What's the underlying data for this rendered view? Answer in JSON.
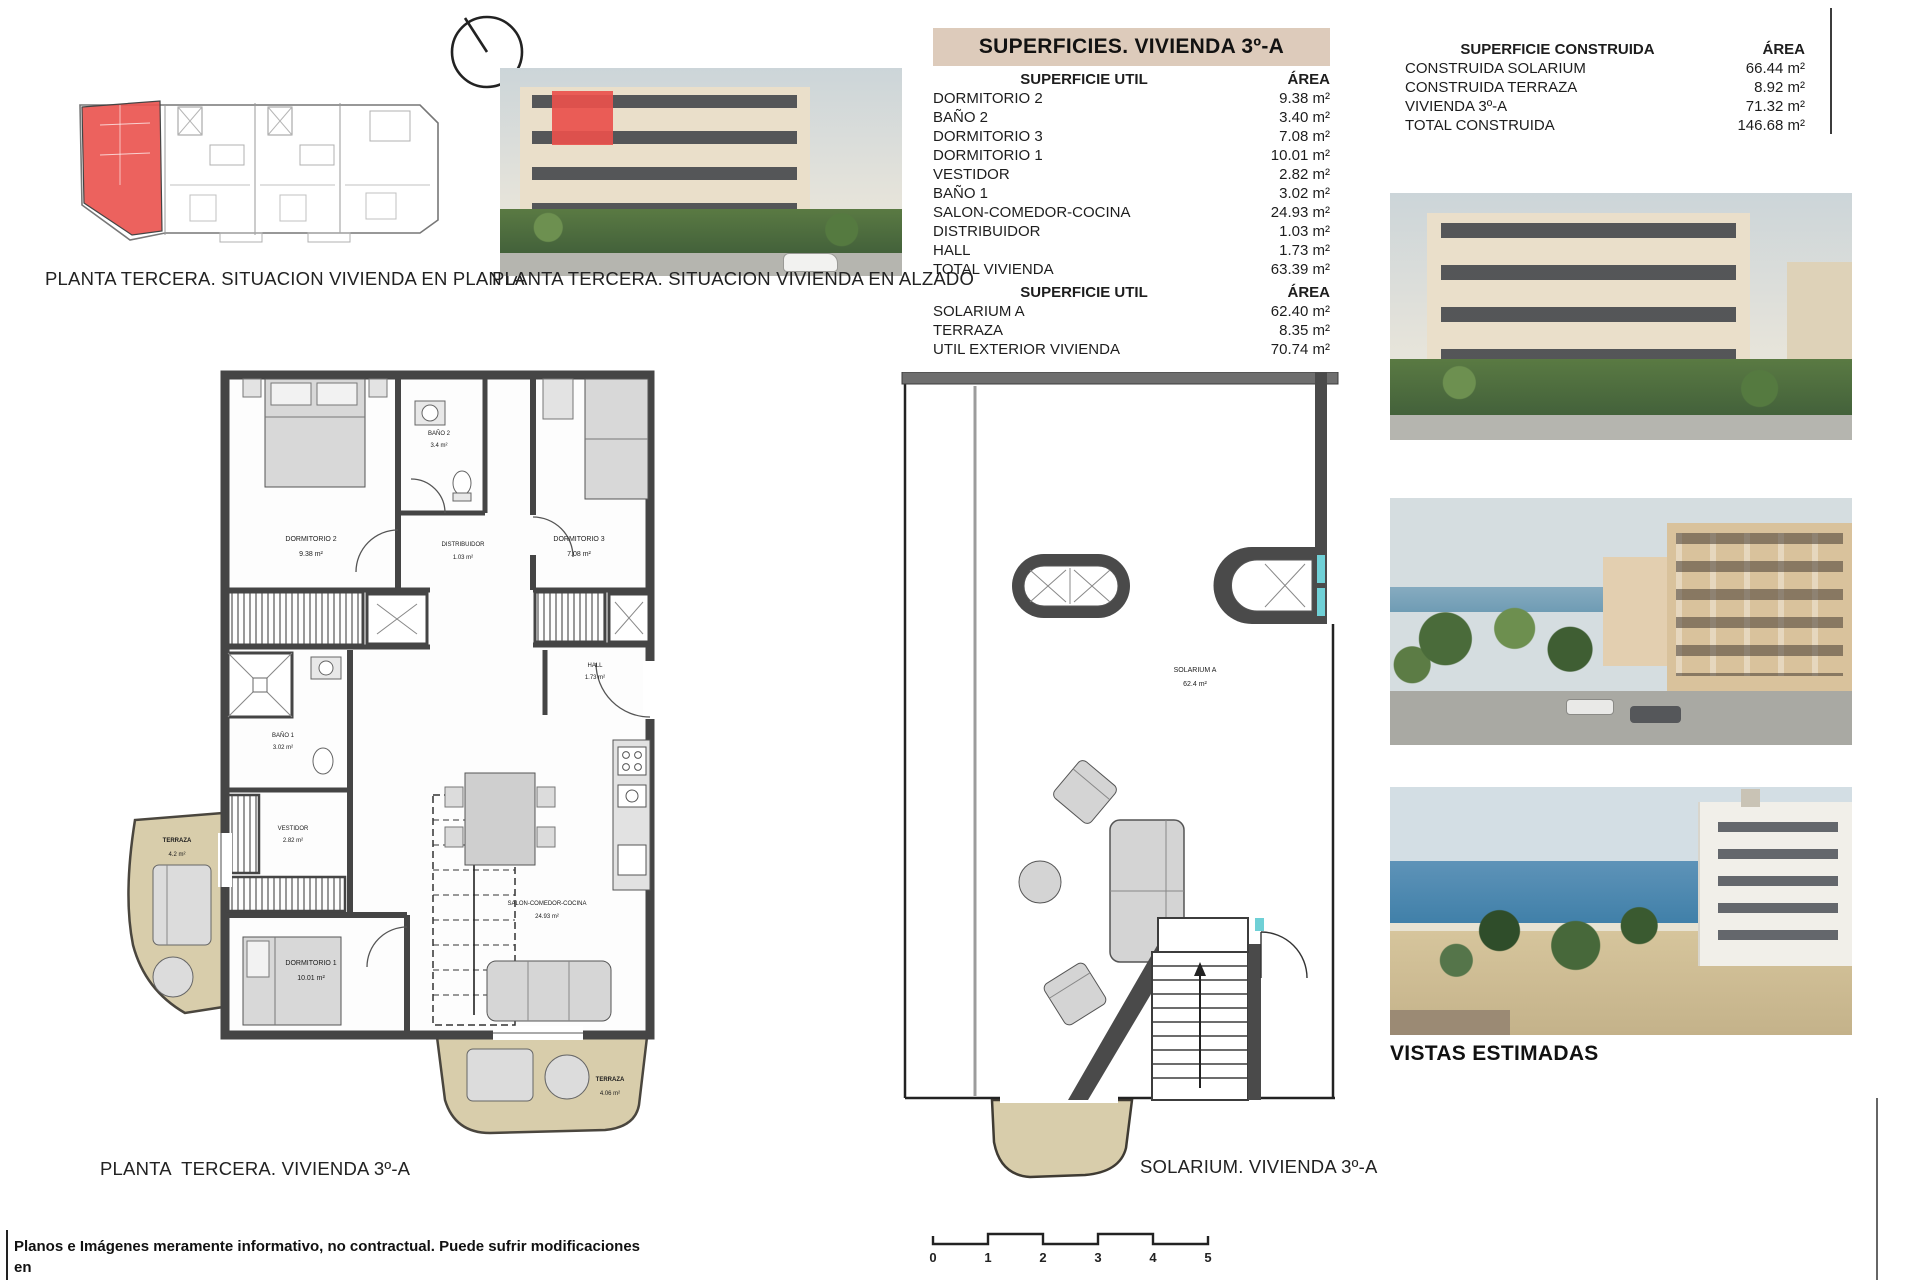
{
  "situacion": {
    "planta_caption": "PLANTA TERCERA. SITUACION VIVIENDA EN PLANTA",
    "alzado_caption": "PLANTA TERCERA. SITUACION VIVIENDA EN ALZADO"
  },
  "superficies_table": {
    "title": "SUPERFICIES. VIVIENDA 3º-A",
    "util_vivienda": {
      "header_label": "SUPERFICIE UTIL",
      "header_area": "ÁREA",
      "rows": [
        {
          "label": "DORMITORIO 2",
          "area": "9.38 m²"
        },
        {
          "label": "BAÑO 2",
          "area": "3.40 m²"
        },
        {
          "label": "DORMITORIO 3",
          "area": "7.08 m²"
        },
        {
          "label": "DORMITORIO 1",
          "area": "10.01 m²"
        },
        {
          "label": "VESTIDOR",
          "area": "2.82 m²"
        },
        {
          "label": "BAÑO 1",
          "area": "3.02 m²"
        },
        {
          "label": "SALON-COMEDOR-COCINA",
          "area": "24.93 m²"
        },
        {
          "label": "DISTRIBUIDOR",
          "area": "1.03 m²"
        },
        {
          "label": "HALL",
          "area": "1.73 m²"
        },
        {
          "label": "TOTAL VIVIENDA",
          "area": "63.39 m²"
        }
      ]
    },
    "util_exterior": {
      "header_label": "SUPERFICIE UTIL",
      "header_area": "ÁREA",
      "rows": [
        {
          "label": "SOLARIUM A",
          "area": "62.40 m²"
        },
        {
          "label": "TERRAZA",
          "area": "8.35 m²"
        },
        {
          "label": "UTIL EXTERIOR VIVIENDA",
          "area": "70.74 m²"
        }
      ]
    }
  },
  "construida_table": {
    "header_label": "SUPERFICIE CONSTRUIDA",
    "header_area": "ÁREA",
    "rows": [
      {
        "label": "CONSTRUIDA SOLARIUM",
        "area": "66.44 m²"
      },
      {
        "label": "CONSTRUIDA TERRAZA",
        "area": "8.92 m²"
      },
      {
        "label": "VIVIENDA 3º-A",
        "area": "71.32 m²"
      },
      {
        "label": "TOTAL CONSTRUIDA",
        "area": "146.68 m²"
      }
    ]
  },
  "floor_plan": {
    "caption": "PLANTA  TERCERA. VIVIENDA 3º-A",
    "rooms": [
      {
        "name": "DORMITORIO 2",
        "area": "9.38 m²"
      },
      {
        "name": "BAÑO 2",
        "area": "3.4 m²"
      },
      {
        "name": "DISTRIBUIDOR",
        "area": "1.03 m²"
      },
      {
        "name": "DORMITORIO 3",
        "area": "7.08 m²"
      },
      {
        "name": "HALL",
        "area": "1.73 m²"
      },
      {
        "name": "BAÑO 1",
        "area": "3.02 m²"
      },
      {
        "name": "VESTIDOR",
        "area": "2.82 m²"
      },
      {
        "name": "DORMITORIO 1",
        "area": "10.01 m²"
      },
      {
        "name": "SALON-COMEDOR-COCINA",
        "area": "24.93 m²"
      },
      {
        "name": "TERRAZA",
        "area": "4.2 m²"
      },
      {
        "name": "TERRAZA",
        "area": "4.06 m²"
      }
    ]
  },
  "solarium_plan": {
    "caption": "SOLARIUM. VIVIENDA 3º-A",
    "room_label": "SOLARIUM A",
    "room_area": "62.4 m²"
  },
  "vistas": {
    "label": "VISTAS ESTIMADAS"
  },
  "scale_bar": {
    "ticks": [
      "0",
      "1",
      "2",
      "3",
      "4",
      "5"
    ]
  },
  "disclaimer": {
    "line1": "Planos e Imágenes meramente informativo, no contractual. Puede sufrir modificaciones en",
    "line2": "el proceso de realización del Proyecto o de la concesión de la Licencia de Construcción."
  },
  "icons": {
    "north_indicator": "circle-with-bearing-line"
  },
  "colors": {
    "table_title_bg": "#ddcbbb",
    "wall_dark": "#474747",
    "terrace_fill": "#d8cdab",
    "highlight_red": "#e8534f",
    "teal_accent": "#6fd0d6",
    "sea_blue": "#4f8cb5"
  }
}
